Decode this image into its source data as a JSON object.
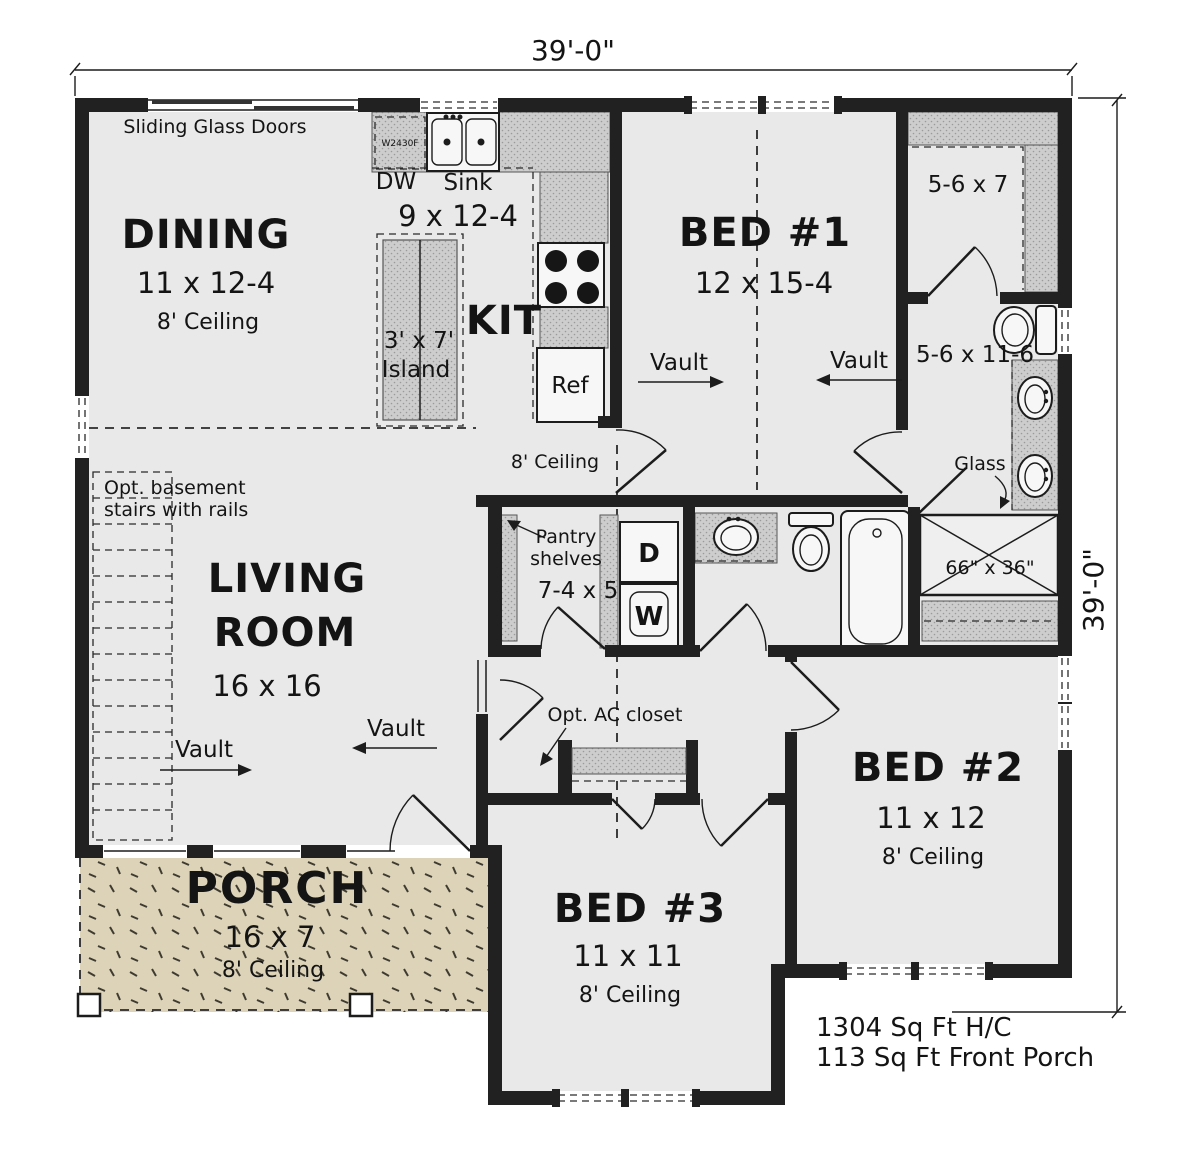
{
  "dimensions": {
    "width_label": "39'-0\"",
    "height_label": "39'-0\""
  },
  "totals": {
    "heated": "1304 Sq Ft H/C",
    "front_porch": "113 Sq Ft Front Porch"
  },
  "rooms": {
    "dining": {
      "name": "DINING",
      "size": "11 x 12-4",
      "ceiling": "8' Ceiling"
    },
    "kitchen": {
      "name": "KIT",
      "size": "9 x 12-4",
      "dw": "DW",
      "sink": "Sink",
      "island_size": "3' x 7'",
      "island": "Island",
      "ref": "Ref",
      "cabinet": "W2430F"
    },
    "living": {
      "name_line1": "LIVING",
      "name_line2": "ROOM",
      "size": "16 x 16"
    },
    "hall": {
      "ceiling": "8' Ceiling"
    },
    "bed1": {
      "name": "BED #1",
      "size": "12 x 15-4"
    },
    "bed2": {
      "name": "BED #2",
      "size": "11 x 12",
      "ceiling": "8' Ceiling"
    },
    "bed3": {
      "name": "BED #3",
      "size": "11 x 11",
      "ceiling": "8' Ceiling"
    },
    "porch": {
      "name": "PORCH",
      "size": "16 x 7",
      "ceiling": "8' Ceiling"
    },
    "closet": {
      "size": "5-6 x 7"
    },
    "bath": {
      "size": "5-6 x 11-6",
      "glass": "Glass",
      "shower_size": "66\" x 36\""
    },
    "laundry": {
      "size": "7-4 x 5",
      "pantry_line1": "Pantry",
      "pantry_line2": "shelves",
      "dryer": "D",
      "washer": "W"
    }
  },
  "annotations": {
    "sliding_doors": "Sliding Glass Doors",
    "stairs_line1": "Opt. basement",
    "stairs_line2": "stairs with rails",
    "ac_closet": "Opt. AC closet",
    "vault": "Vault"
  },
  "colors": {
    "wall": "#212121",
    "floor": "#e9e9e9",
    "porch": "#dcd3b8",
    "counter": "#cdcdcd",
    "background": "#ffffff"
  }
}
